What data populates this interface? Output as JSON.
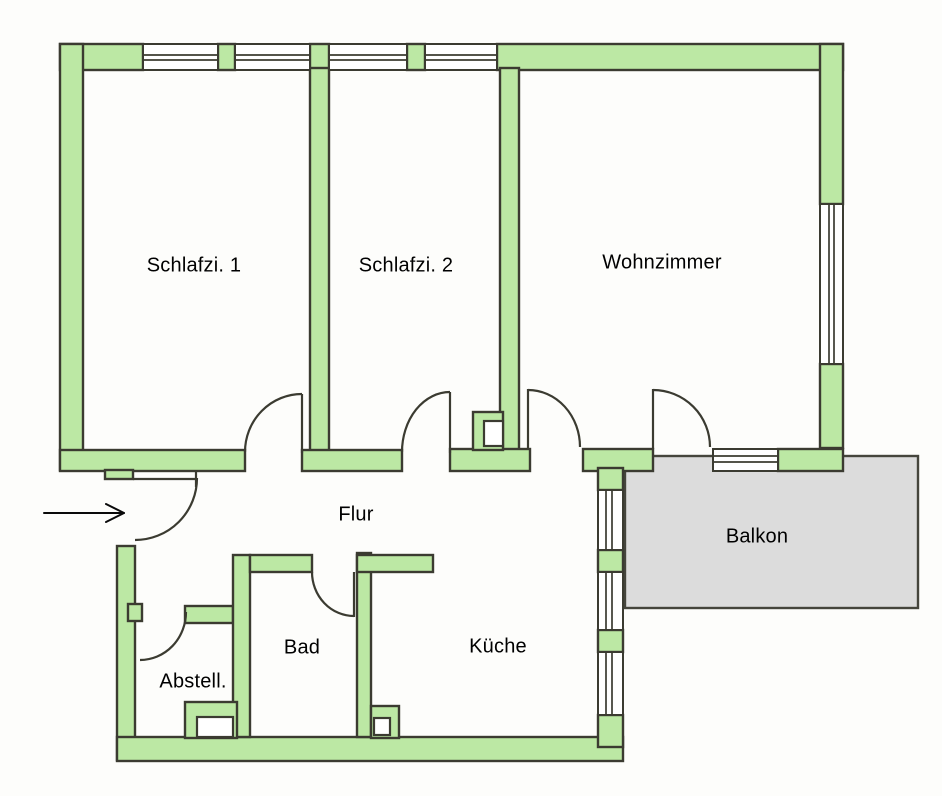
{
  "floorplan": {
    "type": "apartment-floor-plan",
    "rooms": [
      {
        "id": "schlafzimmer-1",
        "label": "Schlafzi. 1"
      },
      {
        "id": "schlafzimmer-2",
        "label": "Schlafzi. 2"
      },
      {
        "id": "wohnzimmer",
        "label": "Wohnzimmer"
      },
      {
        "id": "flur",
        "label": "Flur"
      },
      {
        "id": "balkon",
        "label": "Balkon"
      },
      {
        "id": "bad",
        "label": "Bad"
      },
      {
        "id": "kueche",
        "label": "Küche"
      },
      {
        "id": "abstellraum",
        "label": "Abstell."
      }
    ],
    "icons": [
      {
        "id": "entrance-arrow",
        "meaning": "entrance direction arrow pointing right at apartment door"
      }
    ],
    "colors": {
      "wall_fill": "#bce8a4",
      "wall_outline": "#3b3b31",
      "balcony_fill": "#dcdcdc",
      "balcony_outline": "#45453c",
      "background": "#fdfdfb",
      "text": "#000000"
    }
  }
}
